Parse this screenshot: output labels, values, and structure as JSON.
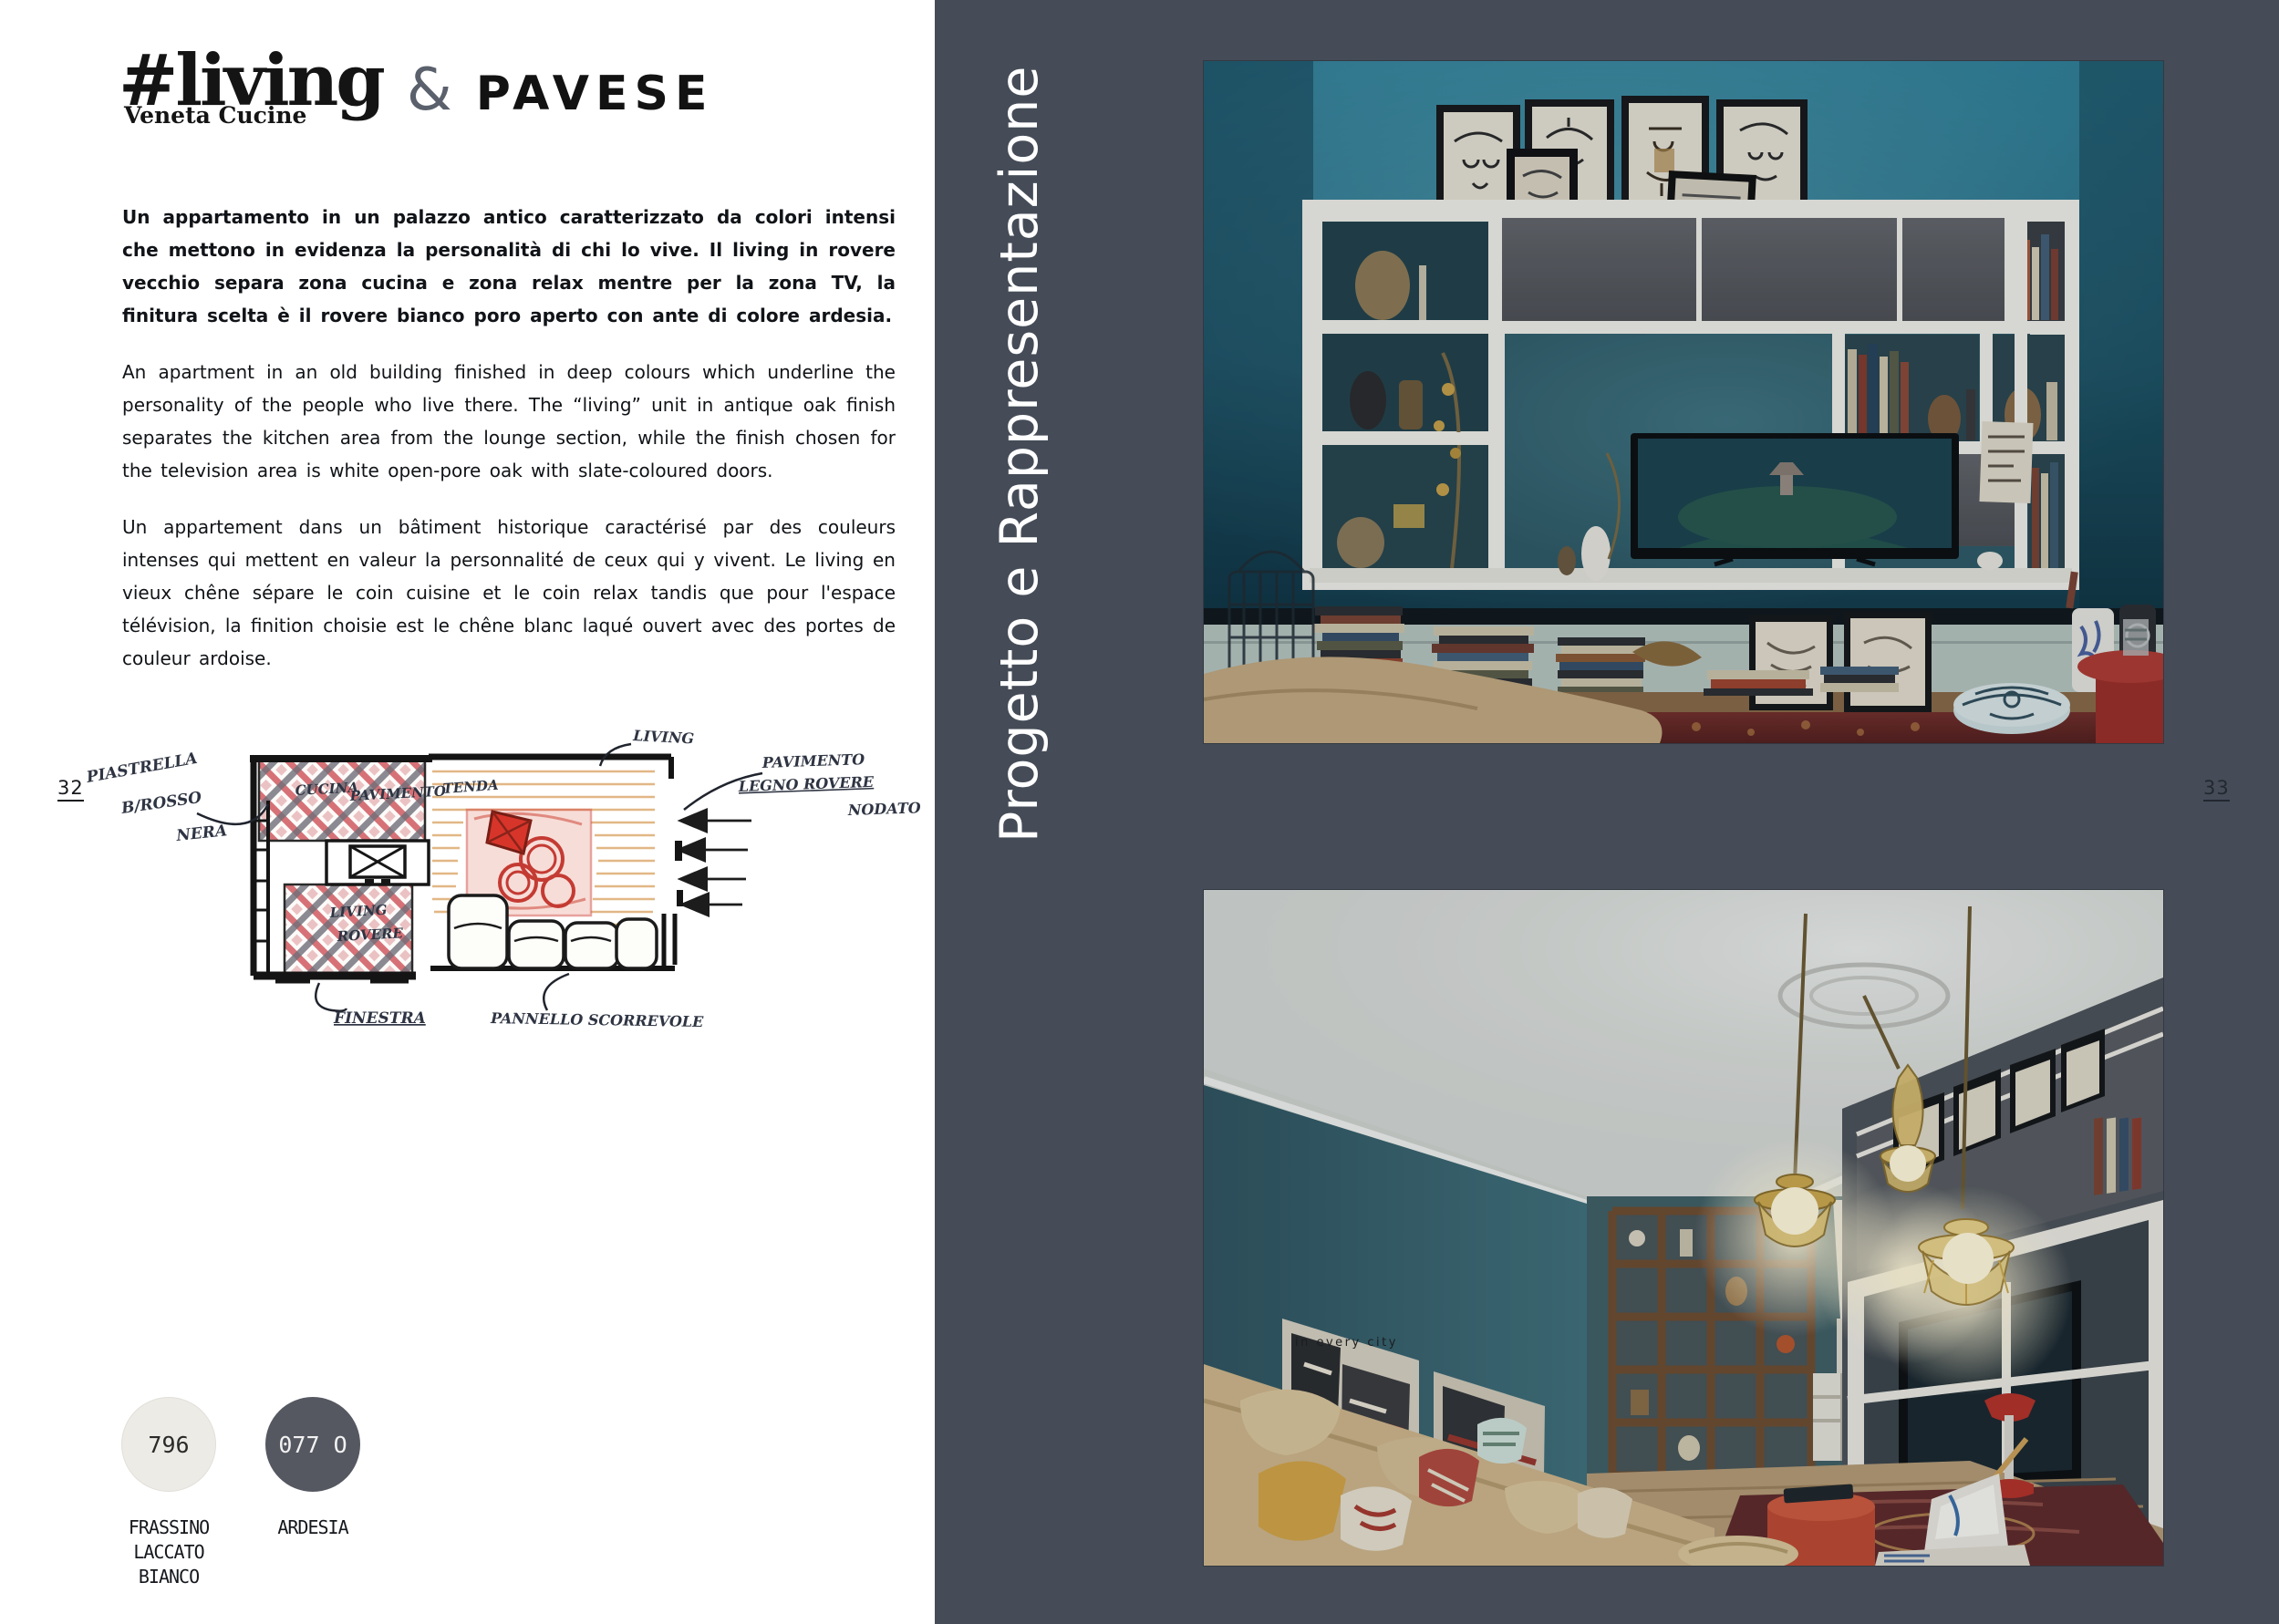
{
  "page": {
    "left_number": "32",
    "right_number": "33"
  },
  "brand": {
    "logo_main": "#living",
    "logo_sub": "Veneta Cucine",
    "ampersand": "&",
    "partner": "PAVESE"
  },
  "intro": {
    "italian": "Un appartamento in un palazzo antico caratterizzato da colori intensi che mettono in evidenza la personalità di chi lo vive. Il living in rovere vecchio separa zona cucina e zona relax mentre per la zona TV, la finitura scelta è il rovere bianco poro aperto con ante di colore ardesia.",
    "english": "An apartment in an old building finished in deep colours which underline the personality of the people who live there. The “living” unit in antique oak finish separates the kitchen area from the lounge section, while the finish chosen for the television area is white open-pore oak with slate-coloured doors.",
    "french": "Un appartement dans un bâtiment historique caractérisé par des couleurs intenses qui mettent en valeur la personnalité de ceux qui y vivent. Le living en vieux chêne sépare le coin cuisine et le coin relax tandis que pour l'espace télévision, la finition choisie est le chêne blanc laqué ouvert avec des portes de couleur ardoise."
  },
  "sidebar": {
    "title": "Progetto e Rappresentazione"
  },
  "sketch": {
    "annotations": {
      "tiles_1": "PIASTRELLA",
      "tiles_2": "B/ROSSO",
      "tiles_3": "NERA",
      "kitchen_floor_1": "CUCINA",
      "kitchen_floor_2": "PAVIMENTO",
      "living_floor_1": "LIVING",
      "living_floor_2": "ROVERE",
      "curtain": "TENDA",
      "living": "LIVING",
      "wood_floor_1": "PAVIMENTO",
      "wood_floor_2": "LEGNO ROVERE",
      "wood_floor_3": "NODATO",
      "window": "FINESTRA",
      "sliding_panel": "PANNELLO SCORREVOLE"
    }
  },
  "finishes": [
    {
      "code": "796",
      "name": "FRASSINO\nLACCATO BIANCO",
      "color": "#edebe5",
      "text_color": "#2a2a2a"
    },
    {
      "code": "077 O",
      "name": "ARDESIA",
      "color": "#555861",
      "text_color": "#f2f2f2"
    }
  ],
  "photos": {
    "lounge": {
      "poster_caption": "in every city"
    }
  },
  "palette": {
    "ink": "#454c58",
    "paper": "#ffffff",
    "teal-wall": "#2e7d96",
    "accent-red": "#b23a35"
  }
}
